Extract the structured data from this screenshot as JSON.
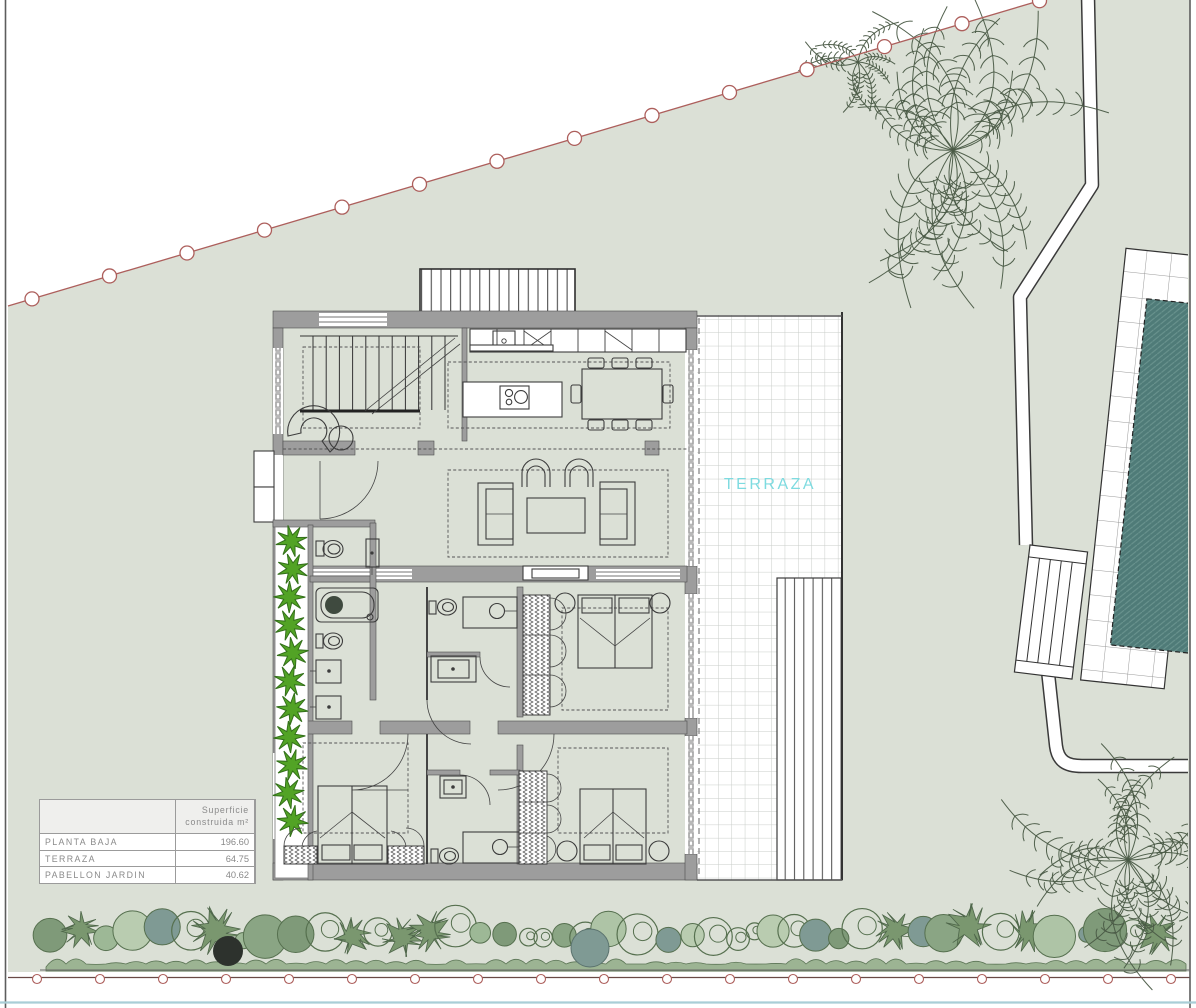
{
  "plan": {
    "terrace_label": "TERRAZA"
  },
  "areas_table": {
    "header_line1": "Superficie",
    "header_line2": "construida m²",
    "rows": [
      {
        "label": "PLANTA BAJA",
        "value": "196.60"
      },
      {
        "label": "TERRAZA",
        "value": "64.75"
      },
      {
        "label": "PABELLON JARDIN",
        "value": "40.62"
      }
    ]
  },
  "colors": {
    "plot_sage": "#dbe0d6",
    "boundary_red": "#ad5f5c",
    "pool_teal": "#4f7b78",
    "pool_hatch": "#6a948f",
    "terrace_cyan": "#7edbe0",
    "planter_green": "#52a325",
    "wall_gray": "#9d9d9d",
    "hedge_greens": [
      "#9db896",
      "#aec4a6",
      "#8aa584",
      "#b9ccb0",
      "#7f9a79",
      "#7f9a94"
    ],
    "bottom_edge_blue": "#a9ced6"
  }
}
